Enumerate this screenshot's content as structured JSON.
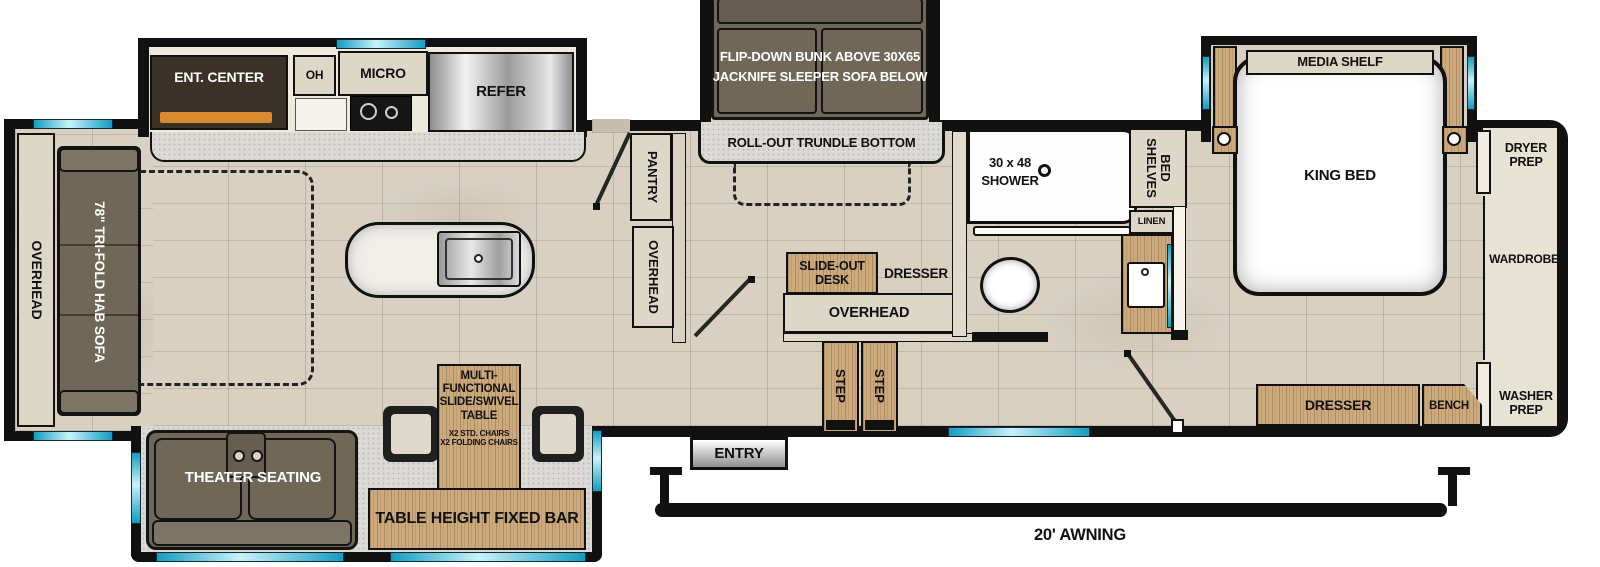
{
  "plan": {
    "front": {
      "overhead": "OVERHEAD",
      "sofa": "78\" TRI-FOLD HAB SOFA"
    },
    "kitchen": {
      "ent_center": "ENT. CENTER",
      "oh": "OH",
      "micro": "MICRO",
      "refer": "REFER",
      "pantry": "PANTRY",
      "overhead": "OVERHEAD"
    },
    "bunk": {
      "line1": "FLIP-DOWN BUNK ABOVE 30X65",
      "line2": "JACKNIFE SLEEPER SOFA BELOW",
      "trundle": "ROLL-OUT TRUNDLE BOTTOM"
    },
    "hall": {
      "desk_line1": "SLIDE-OUT",
      "desk_line2": "DESK",
      "dresser": "DRESSER",
      "overhead": "OVERHEAD",
      "step": "STEP",
      "entry": "ENTRY"
    },
    "bath": {
      "shower_line1": "30 x 48",
      "shower_line2": "SHOWER",
      "bed_shelves": "BED SHELVES",
      "linen": "LINEN"
    },
    "bedroom": {
      "media_shelf": "MEDIA SHELF",
      "king_bed": "KING BED",
      "dryer_prep": "DRYER PREP",
      "wardrobe": "WARDROBE",
      "washer_prep": "WASHER PREP",
      "dresser": "DRESSER",
      "bench": "BENCH"
    },
    "living": {
      "theater": "THEATER SEATING",
      "table_line1": "MULTI-",
      "table_line2": "FUNCTIONAL",
      "table_line3": "SLIDE/SWIVEL",
      "table_line4": "TABLE",
      "table_sub1": "X2 STD. CHAIRS",
      "table_sub2": "X2 FOLDING CHAIRS",
      "bar": "TABLE HEIGHT FIXED BAR"
    },
    "exterior": {
      "awning": "20' AWNING"
    }
  }
}
